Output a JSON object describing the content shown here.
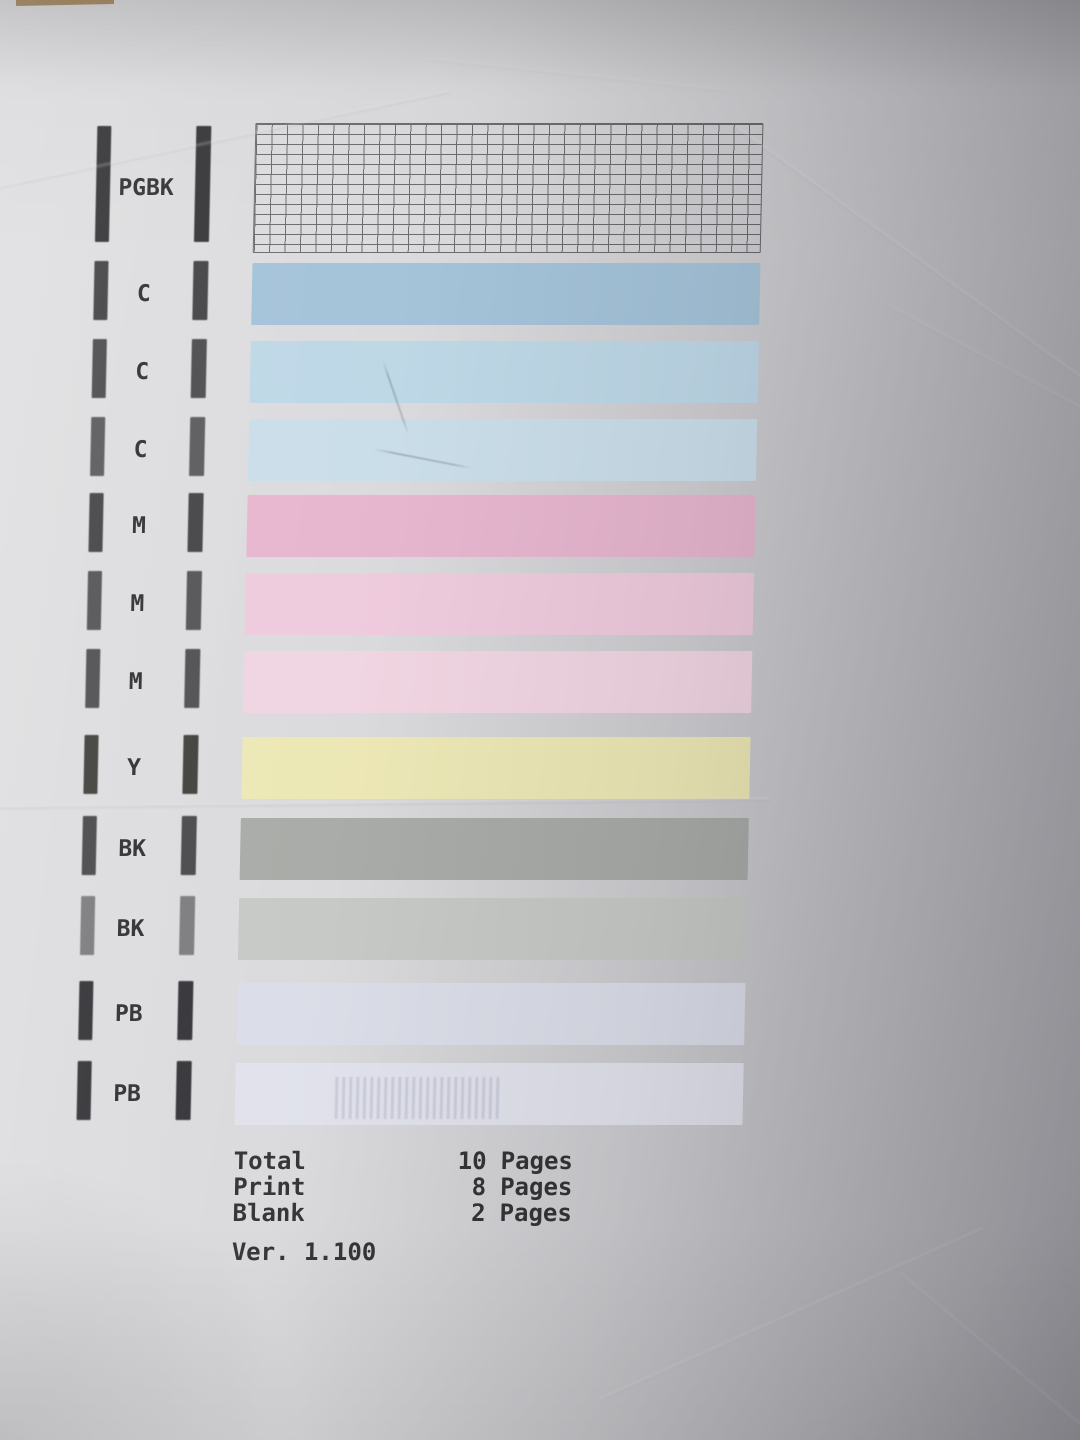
{
  "document": {
    "kind_note": "printer nozzle check pattern sheet",
    "rows": [
      {
        "label": "PGBK",
        "kind": "grid",
        "mark_color": "#333335",
        "bar_color": "#515154"
      },
      {
        "label": "C",
        "kind": "solid",
        "mark_color": "#414144",
        "bar_color": "#a3c2d8"
      },
      {
        "label": "C",
        "kind": "solid",
        "mark_color": "#4a4a4d",
        "bar_color": "#bdd7e6"
      },
      {
        "label": "C",
        "kind": "solid",
        "mark_color": "#59595c",
        "bar_color": "#c9dde9"
      },
      {
        "label": "M",
        "kind": "solid",
        "mark_color": "#424245",
        "bar_color": "#e6b5ce"
      },
      {
        "label": "M",
        "kind": "solid",
        "mark_color": "#525255",
        "bar_color": "#eecadc"
      },
      {
        "label": "M",
        "kind": "solid",
        "mark_color": "#4e4e51",
        "bar_color": "#f0d4e1"
      },
      {
        "label": "Y",
        "kind": "solid",
        "mark_color": "#3e3e3a",
        "bar_color": "#ece7b4"
      },
      {
        "label": "BK",
        "kind": "solid",
        "mark_color": "#47474a",
        "bar_color": "#a7aaa6"
      },
      {
        "label": "BK",
        "kind": "solid",
        "mark_color": "#7b7b7e",
        "bar_color": "#c5c8c4"
      },
      {
        "label": "PB",
        "kind": "solid",
        "mark_color": "#323236",
        "bar_color": "#dadce7"
      },
      {
        "label": "PB",
        "kind": "solid",
        "mark_color": "#333337",
        "bar_color": "#e0e1eb",
        "streaks": true
      }
    ]
  },
  "footer": {
    "lines": [
      {
        "label": "Total",
        "value": "10",
        "unit": "Pages"
      },
      {
        "label": "Print",
        "value": "8",
        "unit": "Pages"
      },
      {
        "label": "Blank",
        "value": "2",
        "unit": "Pages"
      }
    ],
    "version": "Ver. 1.100"
  },
  "colors": {
    "paper": "#d7d7da",
    "grid_line": "#515154",
    "text": "#323234"
  }
}
